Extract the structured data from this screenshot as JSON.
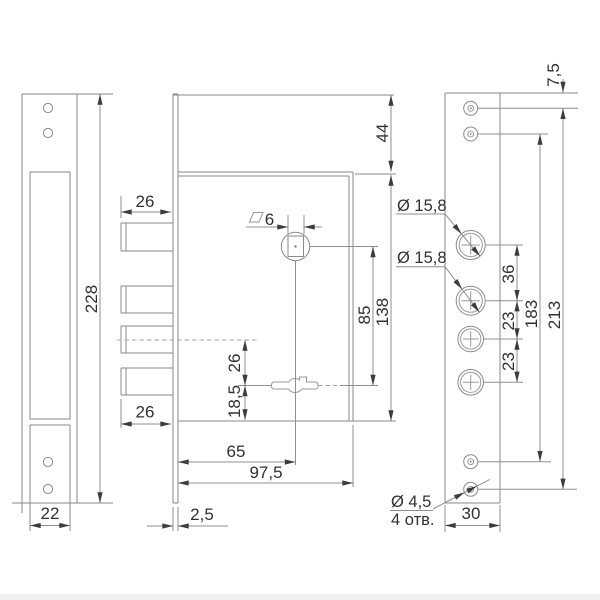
{
  "dims": {
    "left_height": "228",
    "left_width": "22",
    "top_offset": "44",
    "square_size": "6",
    "bolt_len_top": "26",
    "bolt_len_bottom": "26",
    "bolt_center": "26",
    "key_bottom": "18,5",
    "square_key": "85",
    "body_height": "138",
    "backset": "65",
    "body_width": "97,5",
    "plate_thickness": "2,5",
    "top_hole_offset": "7,5",
    "hole_a": "Ø 15,8",
    "hole_b": "Ø 15,8",
    "hole_gap_ab": "36",
    "hole_gap_bc": "23",
    "hole_gap_cd": "23",
    "screw_span_inner": "183",
    "screw_span_outer": "213",
    "right_width": "30",
    "small_hole_dia": "Ø 4,5",
    "small_hole_count": "4 отв."
  }
}
